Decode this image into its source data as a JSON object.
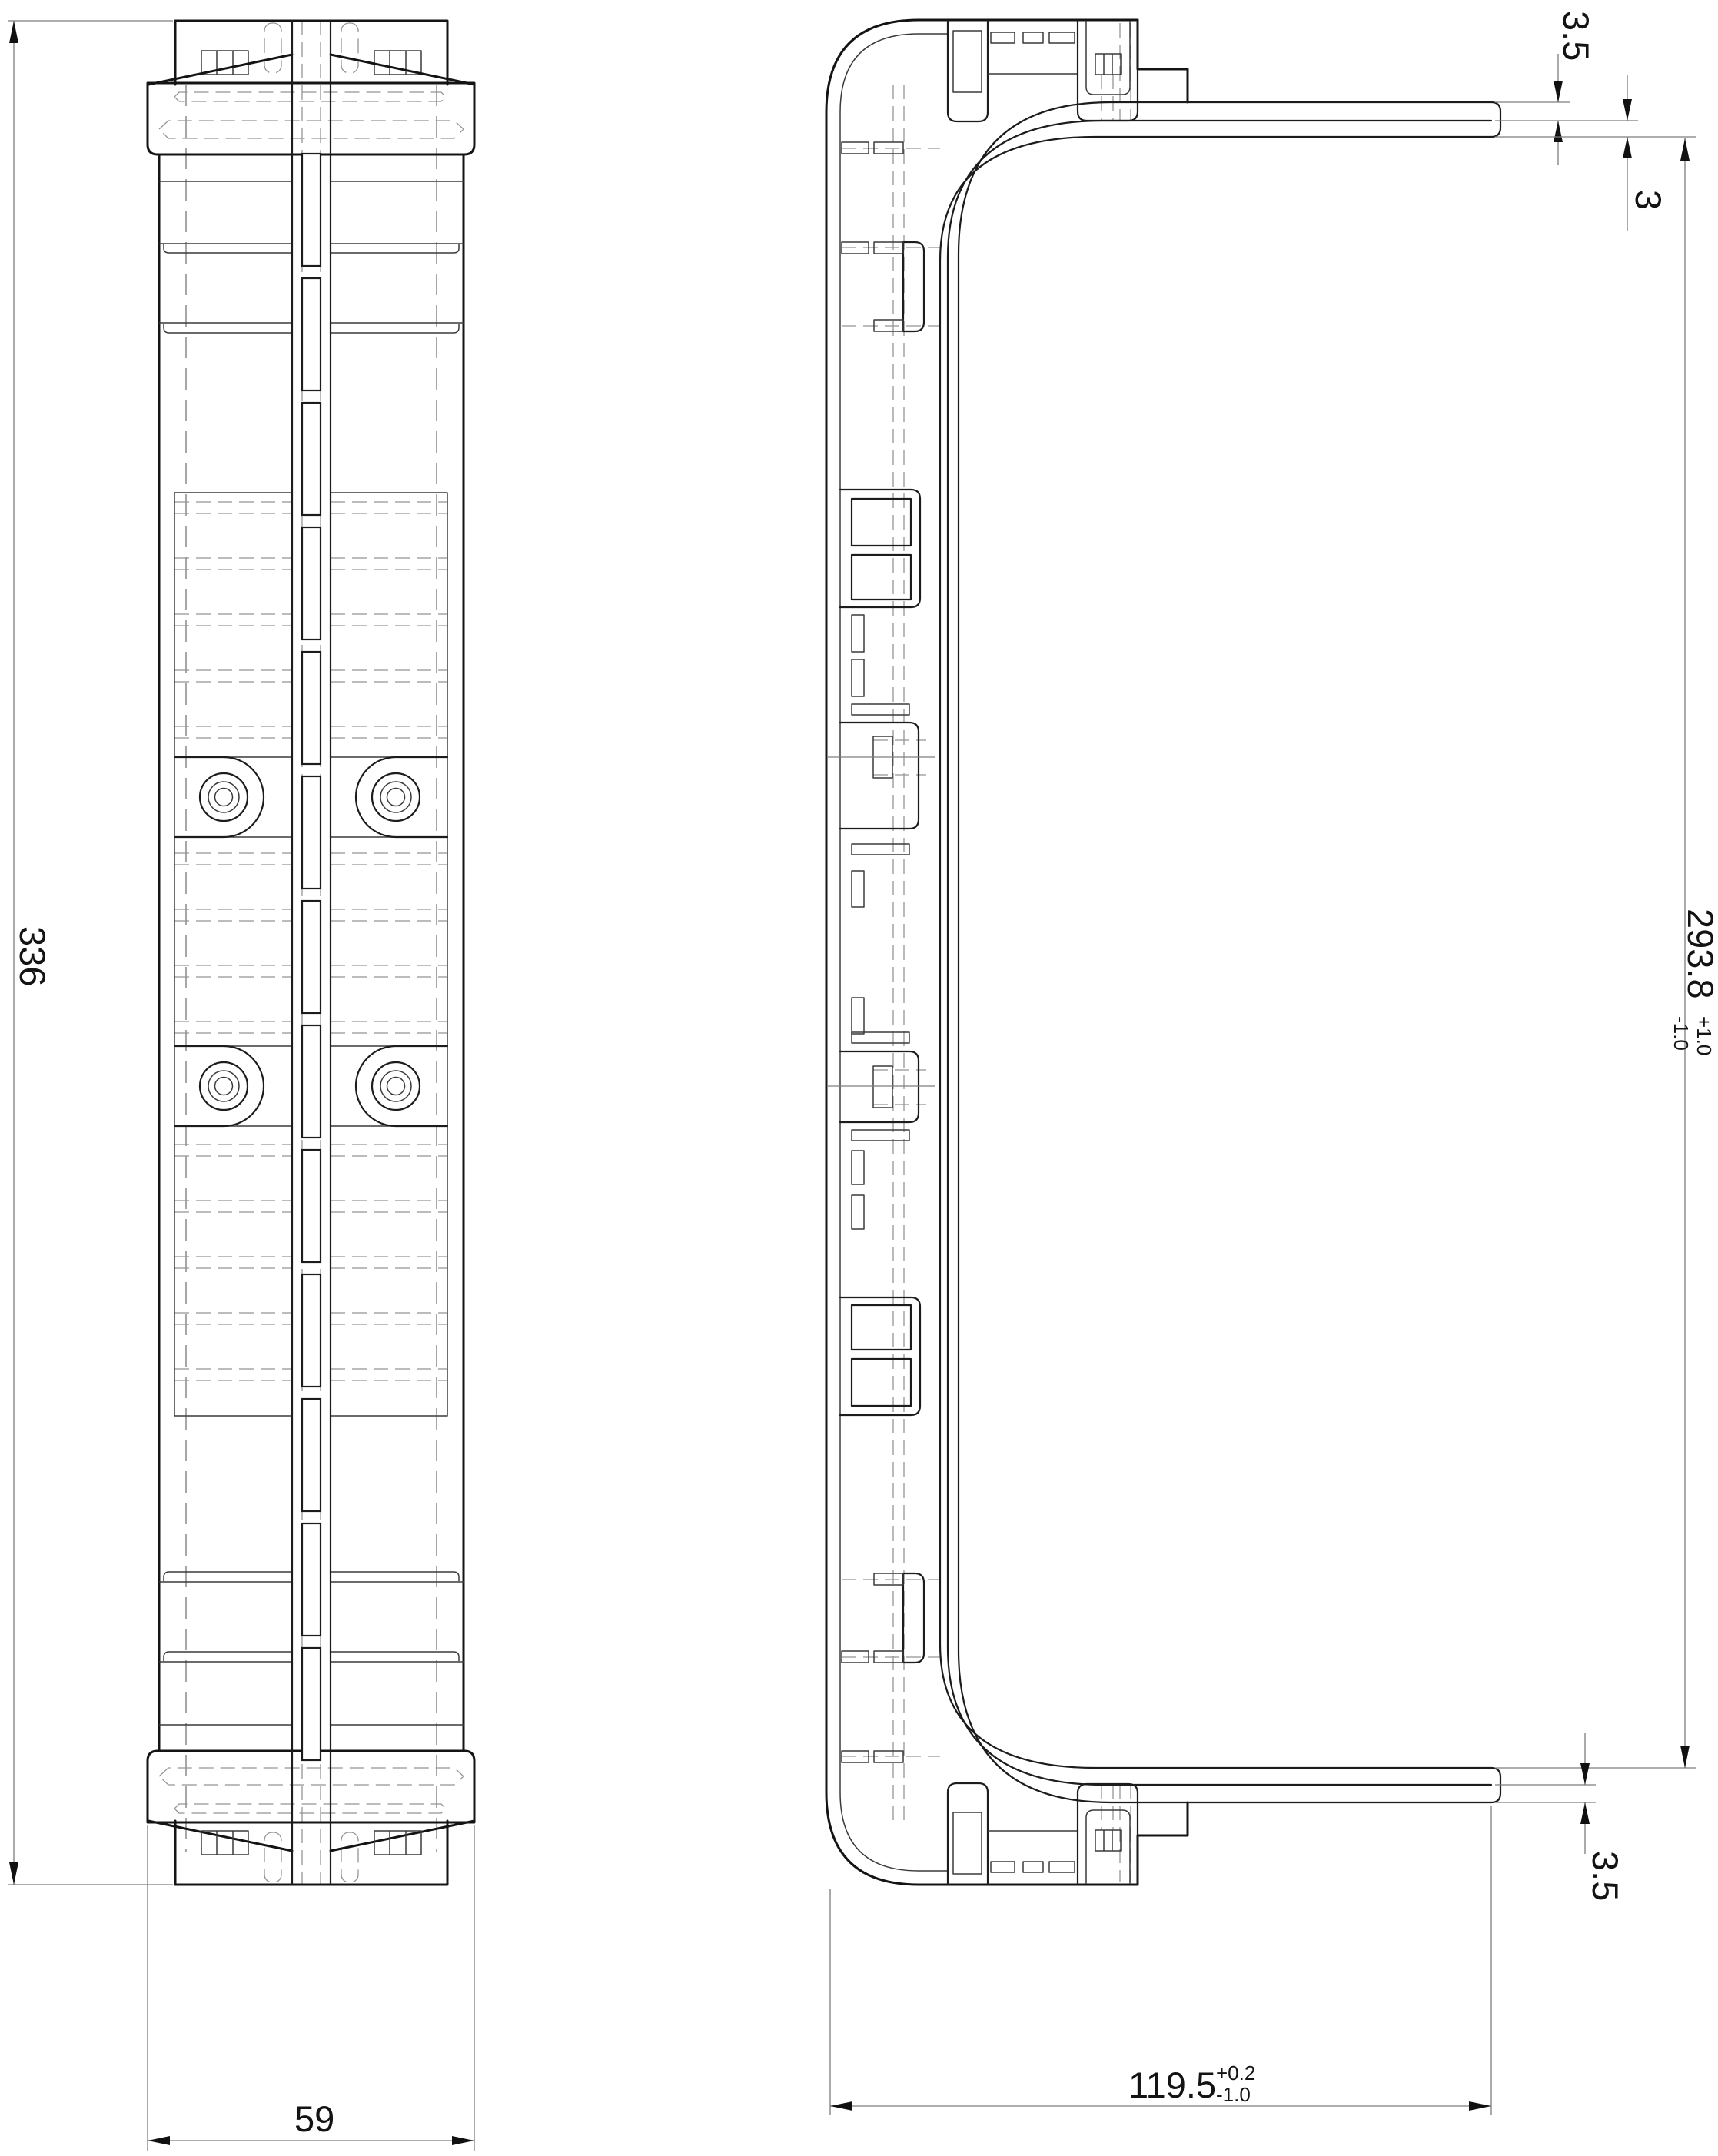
{
  "drawing": {
    "background": "#ffffff",
    "line_color": "#141414",
    "dimension_line_color": "#7d7d7d",
    "views": {
      "front": {
        "label": "front-view"
      },
      "side": {
        "label": "side-section-view"
      }
    },
    "dimensions": {
      "front_overall_height": {
        "value": "336"
      },
      "front_overall_width": {
        "value": "59"
      },
      "side_lip_top_thickness": {
        "value": "3.5"
      },
      "side_lip_step": {
        "value": "3"
      },
      "side_inner_height": {
        "value": "293.8",
        "tol_plus": "+1.0",
        "tol_minus": "-1.0"
      },
      "side_lip_bottom_thickness": {
        "value": "3.5"
      },
      "side_overall_depth": {
        "value": "119.5",
        "tol_plus": "+0.2",
        "tol_minus": "-1.0"
      }
    }
  }
}
